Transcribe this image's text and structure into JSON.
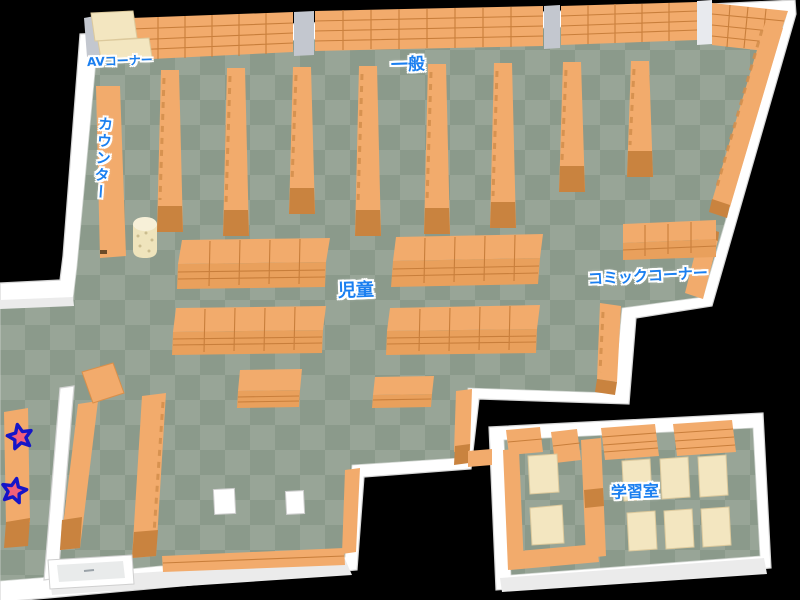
{
  "labels": {
    "av_corner": "AVコーナー",
    "general": "一般",
    "counter": "カウンター",
    "children": "児童",
    "comic_corner": "コミックコーナー",
    "study_room": "学習室"
  },
  "markers": {
    "icon": "star-marker",
    "count": 2
  },
  "colors": {
    "background": "#000000",
    "wall": "#ffffff",
    "wall-shade": "#ebebeb",
    "floor-light": "#98a597",
    "floor-dark": "#8b9a8b",
    "shelf-top": "#f2ab6c",
    "shelf-front": "#e9a05c",
    "shelf-side": "#c9833f",
    "shelf-line": "#c87e3b",
    "desk": "#f3e6c0",
    "pillar": "#c3c7cf",
    "label-blue": "#1a7ff0",
    "star-fill": "#f2607a",
    "star-stroke": "#1515c8"
  }
}
